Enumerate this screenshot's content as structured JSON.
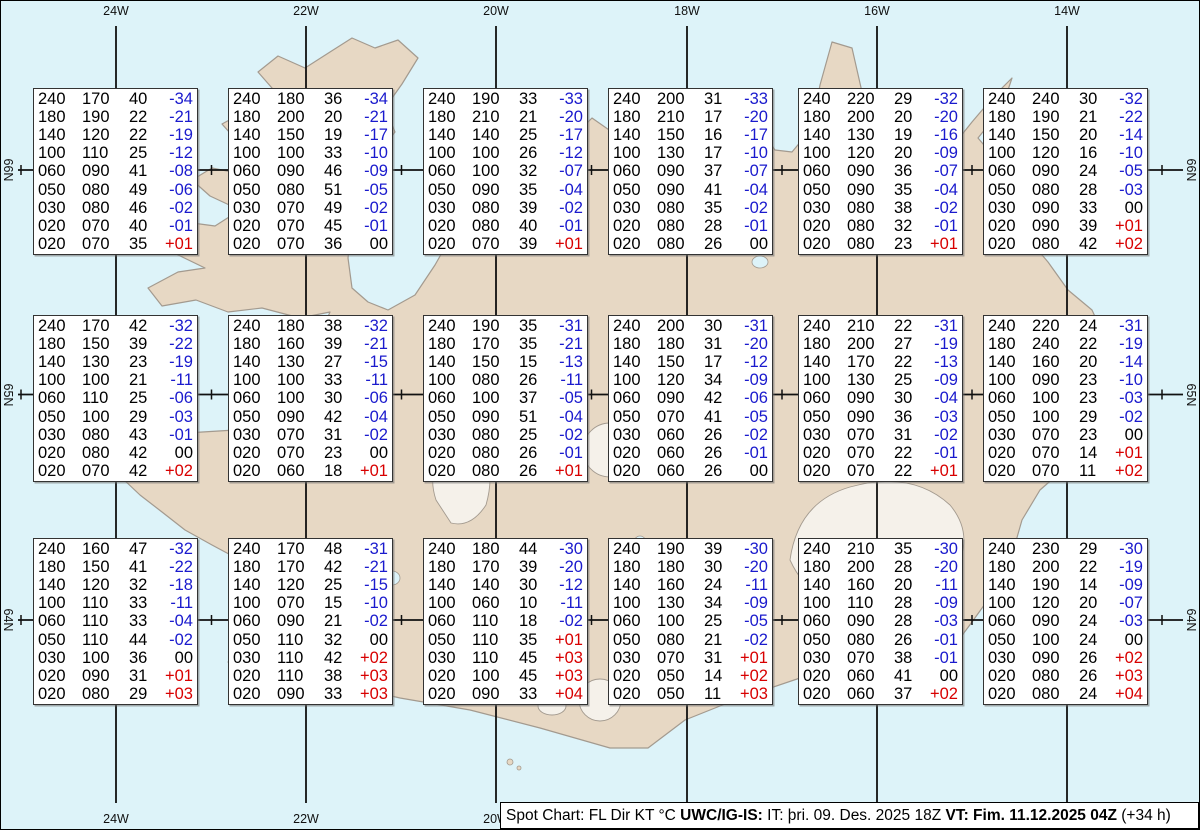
{
  "map": {
    "region_labels": {
      "lon_labels": [
        "24W",
        "22W",
        "20W",
        "18W",
        "16W",
        "14W"
      ],
      "lat_labels": [
        "66N",
        "65N",
        "64N"
      ]
    }
  },
  "status_bar": {
    "segments": [
      {
        "text": "Spot Chart: FL Dir KT °C ",
        "bold": false
      },
      {
        "text": "UWC/IG-IS:",
        "bold": true
      },
      {
        "text": " IT: þri. 09. Des. 2025 18Z ",
        "bold": false
      },
      {
        "text": "VT: Fim. 11.12.2025 04Z",
        "bold": true
      },
      {
        "text": " (+34 h)",
        "bold": false
      }
    ]
  },
  "colors": {
    "ocean": "#ddf3f9",
    "land": "#e7d8c4",
    "coastline": "#a39a8f",
    "glacier": "#f5f1ea",
    "grid_line": "#111111",
    "temp_negative": "#1a1acd",
    "temp_positive": "#d80000",
    "box_background": "#ffffff",
    "box_border": "#333333",
    "status_background": "#ffffff",
    "text": "#000000"
  },
  "spot_rows": [
    [
      [
        [
          "240",
          "170",
          "40",
          "-34"
        ],
        [
          "180",
          "190",
          "22",
          "-21"
        ],
        [
          "140",
          "120",
          "22",
          "-19"
        ],
        [
          "100",
          "110",
          "25",
          "-12"
        ],
        [
          "060",
          "090",
          "41",
          "-08"
        ],
        [
          "050",
          "080",
          "49",
          "-06"
        ],
        [
          "030",
          "080",
          "46",
          "-02"
        ],
        [
          "020",
          "070",
          "40",
          "-01"
        ],
        [
          "020",
          "070",
          "35",
          "+01"
        ]
      ],
      [
        [
          "240",
          "180",
          "36",
          "-34"
        ],
        [
          "180",
          "200",
          "20",
          "-21"
        ],
        [
          "140",
          "150",
          "19",
          "-17"
        ],
        [
          "100",
          "100",
          "33",
          "-10"
        ],
        [
          "060",
          "090",
          "46",
          "-09"
        ],
        [
          "050",
          "080",
          "51",
          "-05"
        ],
        [
          "030",
          "070",
          "49",
          "-02"
        ],
        [
          "020",
          "070",
          "45",
          "-01"
        ],
        [
          "020",
          "070",
          "36",
          "00"
        ]
      ],
      [
        [
          "240",
          "190",
          "33",
          "-33"
        ],
        [
          "180",
          "210",
          "21",
          "-20"
        ],
        [
          "140",
          "140",
          "25",
          "-17"
        ],
        [
          "100",
          "100",
          "26",
          "-12"
        ],
        [
          "060",
          "100",
          "32",
          "-07"
        ],
        [
          "050",
          "090",
          "35",
          "-04"
        ],
        [
          "030",
          "080",
          "39",
          "-02"
        ],
        [
          "020",
          "080",
          "40",
          "-01"
        ],
        [
          "020",
          "070",
          "39",
          "+01"
        ]
      ],
      [
        [
          "240",
          "200",
          "31",
          "-33"
        ],
        [
          "180",
          "210",
          "17",
          "-20"
        ],
        [
          "140",
          "150",
          "16",
          "-17"
        ],
        [
          "100",
          "130",
          "17",
          "-10"
        ],
        [
          "060",
          "090",
          "37",
          "-07"
        ],
        [
          "050",
          "090",
          "41",
          "-04"
        ],
        [
          "030",
          "080",
          "35",
          "-02"
        ],
        [
          "020",
          "080",
          "28",
          "-01"
        ],
        [
          "020",
          "080",
          "26",
          "00"
        ]
      ],
      [
        [
          "240",
          "220",
          "29",
          "-32"
        ],
        [
          "180",
          "200",
          "20",
          "-20"
        ],
        [
          "140",
          "130",
          "19",
          "-16"
        ],
        [
          "100",
          "120",
          "20",
          "-09"
        ],
        [
          "060",
          "090",
          "36",
          "-07"
        ],
        [
          "050",
          "090",
          "35",
          "-04"
        ],
        [
          "030",
          "080",
          "38",
          "-02"
        ],
        [
          "020",
          "080",
          "32",
          "-01"
        ],
        [
          "020",
          "080",
          "23",
          "+01"
        ]
      ],
      [
        [
          "240",
          "240",
          "30",
          "-32"
        ],
        [
          "180",
          "190",
          "21",
          "-22"
        ],
        [
          "140",
          "150",
          "20",
          "-14"
        ],
        [
          "100",
          "120",
          "16",
          "-10"
        ],
        [
          "060",
          "090",
          "24",
          "-05"
        ],
        [
          "050",
          "080",
          "28",
          "-03"
        ],
        [
          "030",
          "090",
          "33",
          "00"
        ],
        [
          "020",
          "090",
          "39",
          "+01"
        ],
        [
          "020",
          "080",
          "42",
          "+02"
        ]
      ]
    ],
    [
      [
        [
          "240",
          "170",
          "42",
          "-32"
        ],
        [
          "180",
          "150",
          "39",
          "-22"
        ],
        [
          "140",
          "130",
          "23",
          "-19"
        ],
        [
          "100",
          "100",
          "21",
          "-11"
        ],
        [
          "060",
          "110",
          "25",
          "-06"
        ],
        [
          "050",
          "100",
          "29",
          "-03"
        ],
        [
          "030",
          "080",
          "43",
          "-01"
        ],
        [
          "020",
          "080",
          "42",
          "00"
        ],
        [
          "020",
          "070",
          "42",
          "+02"
        ]
      ],
      [
        [
          "240",
          "180",
          "38",
          "-32"
        ],
        [
          "180",
          "160",
          "39",
          "-21"
        ],
        [
          "140",
          "130",
          "27",
          "-15"
        ],
        [
          "100",
          "100",
          "33",
          "-11"
        ],
        [
          "060",
          "100",
          "30",
          "-06"
        ],
        [
          "050",
          "090",
          "42",
          "-04"
        ],
        [
          "030",
          "070",
          "31",
          "-02"
        ],
        [
          "020",
          "070",
          "23",
          "00"
        ],
        [
          "020",
          "060",
          "18",
          "+01"
        ]
      ],
      [
        [
          "240",
          "190",
          "35",
          "-31"
        ],
        [
          "180",
          "170",
          "35",
          "-21"
        ],
        [
          "140",
          "150",
          "15",
          "-13"
        ],
        [
          "100",
          "080",
          "26",
          "-11"
        ],
        [
          "060",
          "100",
          "37",
          "-05"
        ],
        [
          "050",
          "090",
          "51",
          "-04"
        ],
        [
          "030",
          "080",
          "25",
          "-02"
        ],
        [
          "020",
          "080",
          "26",
          "-01"
        ],
        [
          "020",
          "080",
          "26",
          "+01"
        ]
      ],
      [
        [
          "240",
          "200",
          "30",
          "-31"
        ],
        [
          "180",
          "180",
          "31",
          "-20"
        ],
        [
          "140",
          "150",
          "17",
          "-12"
        ],
        [
          "100",
          "120",
          "34",
          "-09"
        ],
        [
          "060",
          "090",
          "42",
          "-06"
        ],
        [
          "050",
          "070",
          "41",
          "-05"
        ],
        [
          "030",
          "060",
          "26",
          "-02"
        ],
        [
          "020",
          "060",
          "26",
          "-01"
        ],
        [
          "020",
          "060",
          "26",
          "00"
        ]
      ],
      [
        [
          "240",
          "210",
          "22",
          "-31"
        ],
        [
          "180",
          "200",
          "27",
          "-19"
        ],
        [
          "140",
          "170",
          "22",
          "-13"
        ],
        [
          "100",
          "130",
          "25",
          "-09"
        ],
        [
          "060",
          "090",
          "30",
          "-04"
        ],
        [
          "050",
          "090",
          "36",
          "-03"
        ],
        [
          "030",
          "070",
          "31",
          "-02"
        ],
        [
          "020",
          "070",
          "22",
          "-01"
        ],
        [
          "020",
          "070",
          "22",
          "+01"
        ]
      ],
      [
        [
          "240",
          "220",
          "24",
          "-31"
        ],
        [
          "180",
          "240",
          "22",
          "-19"
        ],
        [
          "140",
          "160",
          "20",
          "-14"
        ],
        [
          "100",
          "090",
          "23",
          "-10"
        ],
        [
          "060",
          "100",
          "23",
          "-03"
        ],
        [
          "050",
          "100",
          "29",
          "-02"
        ],
        [
          "030",
          "070",
          "23",
          "00"
        ],
        [
          "020",
          "070",
          "14",
          "+01"
        ],
        [
          "020",
          "070",
          "11",
          "+02"
        ]
      ]
    ],
    [
      [
        [
          "240",
          "160",
          "47",
          "-32"
        ],
        [
          "180",
          "150",
          "41",
          "-22"
        ],
        [
          "140",
          "120",
          "32",
          "-18"
        ],
        [
          "100",
          "110",
          "33",
          "-11"
        ],
        [
          "060",
          "110",
          "33",
          "-04"
        ],
        [
          "050",
          "110",
          "44",
          "-02"
        ],
        [
          "030",
          "100",
          "36",
          "00"
        ],
        [
          "020",
          "090",
          "31",
          "+01"
        ],
        [
          "020",
          "080",
          "29",
          "+03"
        ]
      ],
      [
        [
          "240",
          "170",
          "48",
          "-31"
        ],
        [
          "180",
          "170",
          "42",
          "-21"
        ],
        [
          "140",
          "120",
          "25",
          "-15"
        ],
        [
          "100",
          "070",
          "15",
          "-10"
        ],
        [
          "060",
          "090",
          "21",
          "-02"
        ],
        [
          "050",
          "110",
          "32",
          "00"
        ],
        [
          "030",
          "110",
          "42",
          "+02"
        ],
        [
          "020",
          "110",
          "38",
          "+03"
        ],
        [
          "020",
          "090",
          "33",
          "+03"
        ]
      ],
      [
        [
          "240",
          "180",
          "44",
          "-30"
        ],
        [
          "180",
          "170",
          "39",
          "-20"
        ],
        [
          "140",
          "140",
          "30",
          "-12"
        ],
        [
          "100",
          "060",
          "10",
          "-11"
        ],
        [
          "060",
          "110",
          "18",
          "-02"
        ],
        [
          "050",
          "110",
          "35",
          "+01"
        ],
        [
          "030",
          "110",
          "45",
          "+03"
        ],
        [
          "020",
          "100",
          "45",
          "+03"
        ],
        [
          "020",
          "090",
          "33",
          "+04"
        ]
      ],
      [
        [
          "240",
          "190",
          "39",
          "-30"
        ],
        [
          "180",
          "180",
          "30",
          "-20"
        ],
        [
          "140",
          "160",
          "24",
          "-11"
        ],
        [
          "100",
          "130",
          "34",
          "-09"
        ],
        [
          "060",
          "100",
          "25",
          "-05"
        ],
        [
          "050",
          "080",
          "21",
          "-02"
        ],
        [
          "030",
          "070",
          "31",
          "+01"
        ],
        [
          "020",
          "050",
          "14",
          "+02"
        ],
        [
          "020",
          "050",
          "11",
          "+03"
        ]
      ],
      [
        [
          "240",
          "210",
          "35",
          "-30"
        ],
        [
          "180",
          "200",
          "28",
          "-20"
        ],
        [
          "140",
          "160",
          "20",
          "-11"
        ],
        [
          "100",
          "110",
          "28",
          "-09"
        ],
        [
          "060",
          "090",
          "28",
          "-03"
        ],
        [
          "050",
          "080",
          "26",
          "-01"
        ],
        [
          "030",
          "070",
          "38",
          "-01"
        ],
        [
          "020",
          "060",
          "41",
          "00"
        ],
        [
          "020",
          "060",
          "37",
          "+02"
        ]
      ],
      [
        [
          "240",
          "230",
          "29",
          "-30"
        ],
        [
          "180",
          "200",
          "22",
          "-19"
        ],
        [
          "140",
          "190",
          "14",
          "-09"
        ],
        [
          "100",
          "120",
          "20",
          "-07"
        ],
        [
          "060",
          "090",
          "24",
          "-03"
        ],
        [
          "050",
          "100",
          "24",
          "00"
        ],
        [
          "030",
          "090",
          "26",
          "+02"
        ],
        [
          "020",
          "080",
          "26",
          "+03"
        ],
        [
          "020",
          "080",
          "24",
          "+04"
        ]
      ]
    ]
  ]
}
